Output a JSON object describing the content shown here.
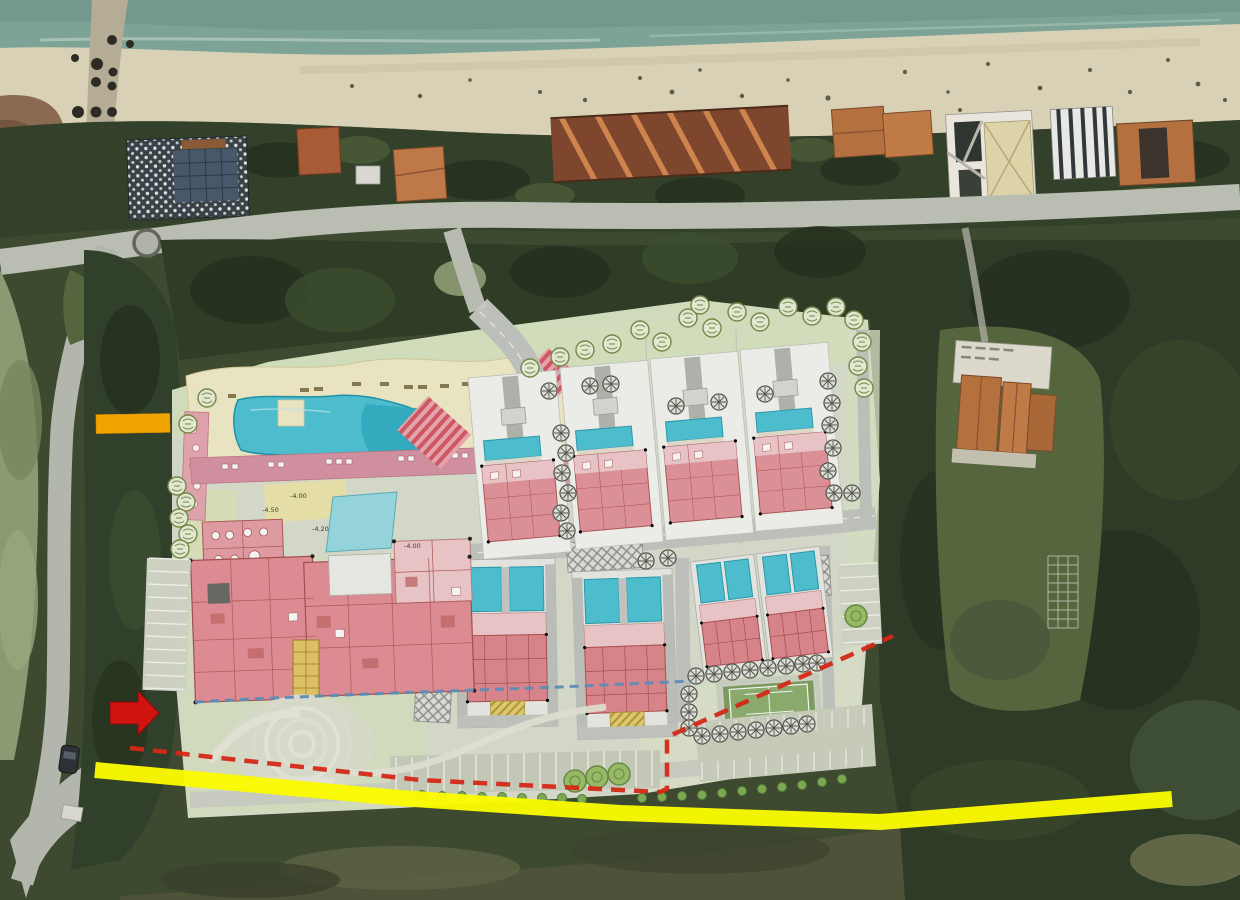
{
  "scene": {
    "kind": "aerial-photo-with-site-plan-overlay",
    "width_px": 1240,
    "height_px": 900
  },
  "annotations": {
    "orange_highlight_dash": {
      "color": "#F0A400",
      "shape": "thick horizontal bar",
      "location": "left edge near access road"
    },
    "red_arrow": {
      "color": "#CF1410",
      "direction": "right",
      "location": "left edge at site entrance"
    },
    "yellow_road_highlight": {
      "color": "#FBFB00",
      "shape": "thick line along southern road",
      "span": "full width"
    },
    "red_dashed_boundary": {
      "color": "#D42818",
      "style": "dashed",
      "location": "southern and eastern plan edge"
    },
    "blue_dashed_line": {
      "color": "#6090C0",
      "style": "dashed",
      "location": "across lower lawn of plan"
    }
  },
  "site_plan": {
    "elevation_labels": [
      {
        "text": "-4.00"
      },
      {
        "text": "-4.50"
      },
      {
        "text": "-4.20"
      },
      {
        "text": "-4.00"
      }
    ],
    "features": [
      {
        "name": "main-swimming-pool",
        "count": 1
      },
      {
        "name": "pool-promenade",
        "count": 1
      },
      {
        "name": "lagoon-pond",
        "count": 1
      },
      {
        "name": "hotel-main-building",
        "count": 1
      },
      {
        "name": "villa-plot",
        "count": 4
      },
      {
        "name": "townhouse-block",
        "count": 3
      },
      {
        "name": "tennis-court",
        "count": 1
      },
      {
        "name": "roundabout-garden",
        "count": 1
      },
      {
        "name": "parking-row",
        "count": 4
      },
      {
        "name": "crosswalk",
        "count": 3
      },
      {
        "name": "tree-symbol",
        "count": "~60"
      }
    ],
    "colors": {
      "backdrop": "#E9EDDE",
      "lawn": "#D9E5C2",
      "deck_cream": "#F3EDCA",
      "pool": "#4EC4D6",
      "pool_deep": "#2FADC4",
      "pond": "#9ADCE4",
      "building_pink": "#E5959E",
      "building_light_pink": "#F2CBD0",
      "promenade_pink": "#D994A6",
      "road_gray": "#C6C8C3",
      "hatch_yellow": "#E7CE6F",
      "tennis_green": "#8FB071"
    }
  },
  "base_photo": {
    "features": [
      "sea",
      "beach",
      "pier",
      "beachfront-buildings",
      "coastal-road",
      "access-road",
      "woodland",
      "neighboring-house",
      "garden-trellis",
      "parked-car"
    ],
    "colors": {
      "sea": "#7CA396",
      "sand": "#D8D1B6",
      "woodland_dark": "#2E3B26",
      "grass": "#8B9A72",
      "road": "#B9BDB2",
      "roof_orange": "#BE7240"
    }
  }
}
